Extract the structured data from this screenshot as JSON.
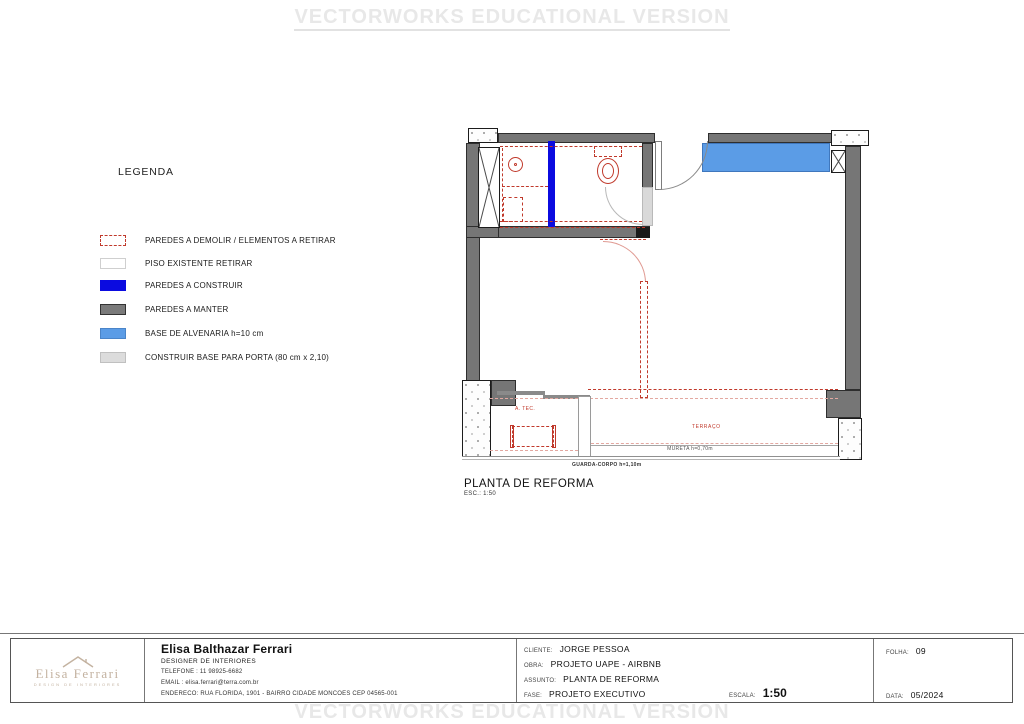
{
  "watermark": {
    "text": "VECTORWORKS EDUCATIONAL VERSION"
  },
  "legend": {
    "title": "LEGENDA",
    "items": [
      {
        "label": "PAREDES A DEMOLIR / ELEMENTOS A RETIRAR",
        "color": "#c0392b"
      },
      {
        "label": "PISO EXISTENTE RETIRAR",
        "color": "#ffffff"
      },
      {
        "label": "PAREDES A CONSTRUIR",
        "color": "#0b0be0"
      },
      {
        "label": "PAREDES A MANTER",
        "color": "#7a7a7a"
      },
      {
        "label": "BASE DE ALVENARIA h=10 cm",
        "color": "#5b9ce6"
      },
      {
        "label": "CONSTRUIR BASE PARA PORTA (80 cm x 2,10)",
        "color": "#dcdcdc"
      }
    ]
  },
  "plan": {
    "title": "PLANTA DE REFORMA",
    "scale_note": "ESC.: 1:50",
    "labels": {
      "area_tecnica": "A. TEC.",
      "terraco": "TERRAÇO",
      "mureta": "MURETA h=0,70m",
      "guarda_corpo": "GUARDA-CORPO h=1,10m"
    }
  },
  "title_block": {
    "company": {
      "logo_name": "Elisa Ferrari",
      "logo_sub": "DESIGN DE INTERIORES",
      "name": "Elisa Balthazar Ferrari",
      "role": "DESIGNER DE INTERIORES",
      "phone": "TELEFONE : 11 98925-6682",
      "email": "EMAIL : elisa.ferrari@terra.com.br",
      "address": "ENDERECO: RUA FLORIDA, 1901 -   BAIRRO CIDADE MONCOES   CEP 04565-001"
    },
    "fields": {
      "cliente_label": "CLIENTE:",
      "cliente": "JORGE PESSOA",
      "obra_label": "OBRA:",
      "obra": "PROJETO UAPE - AIRBNB",
      "assunto_label": "ASSUNTO:",
      "assunto": "PLANTA DE REFORMA",
      "fase_label": "FASE:",
      "fase": "PROJETO EXECUTIVO",
      "escala_label": "ESCALA:",
      "escala": "1:50",
      "folha_label": "FOLHA:",
      "folha": "09",
      "data_label": "DATA:",
      "data": "05/2024"
    }
  },
  "colors": {
    "wall_keep": "#767676",
    "wall_build": "#0b0be0",
    "masonry_base": "#5b9ce6",
    "demolish_red": "#c0392b",
    "door_base": "#dcdcdc",
    "watermark": "#e8e8e8",
    "logo_tan": "#c3b2a0"
  }
}
